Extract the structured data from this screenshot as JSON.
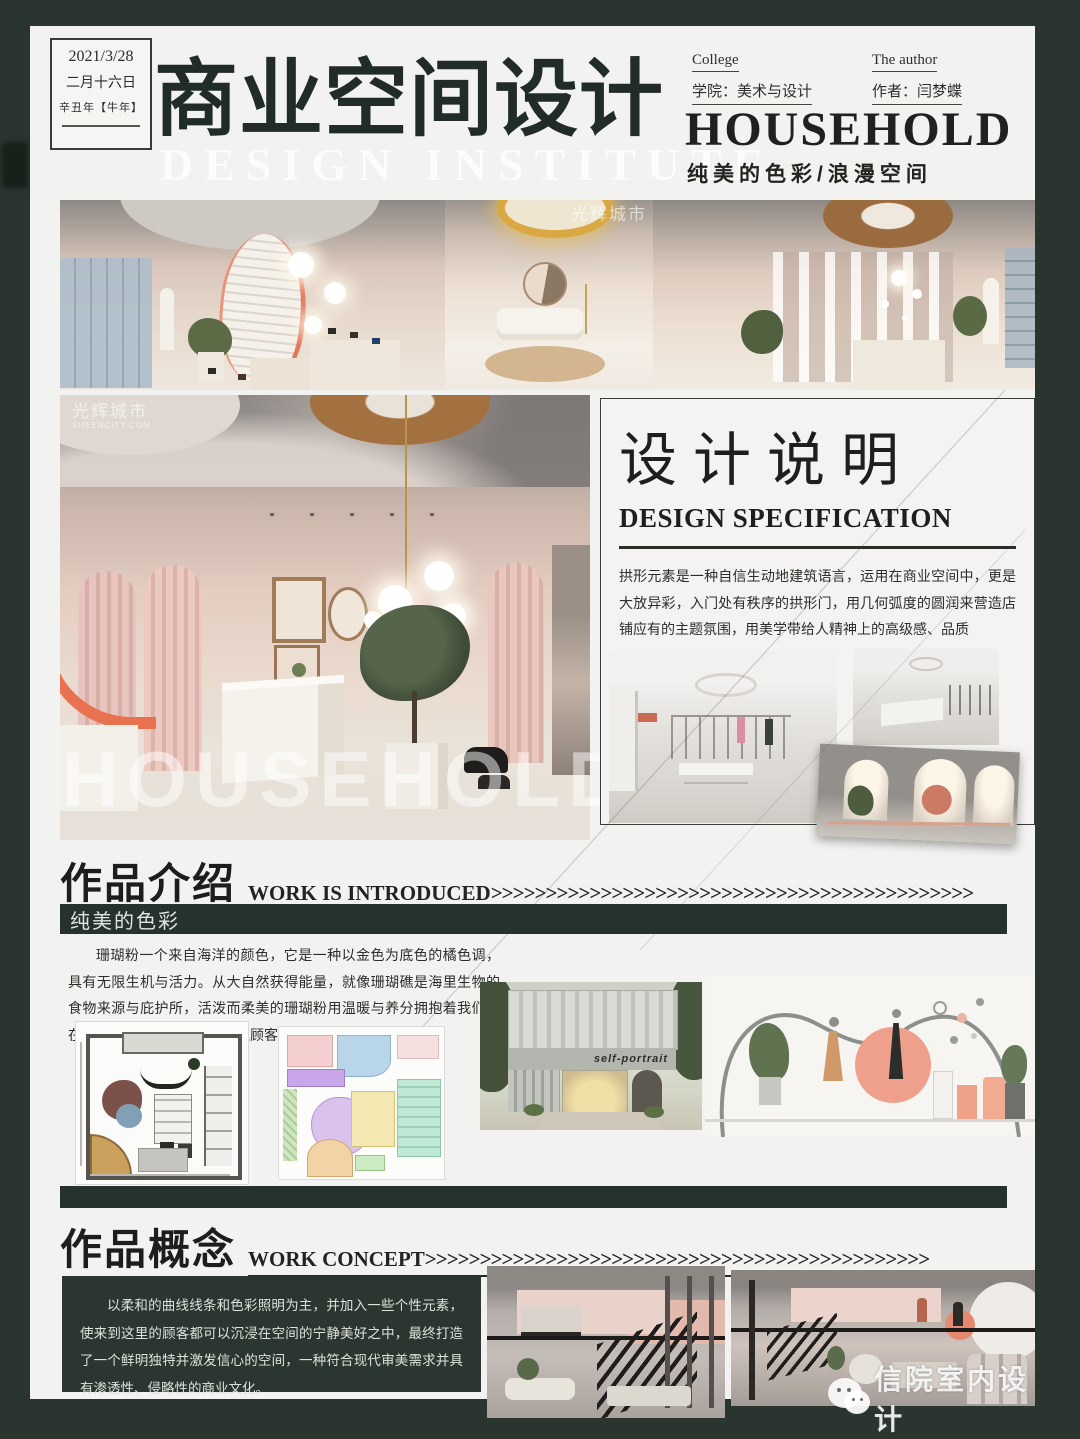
{
  "colors": {
    "accent_green": "#2a362f",
    "coral": "#e8754f",
    "page_bg": "#f2f2f0"
  },
  "header": {
    "date_line1": "2021/3/28",
    "date_line2": "二月十六日",
    "date_line3": "辛丑年【牛年】",
    "title": "商业空间设计",
    "title_watermark": "DESIGN INSTITUTE",
    "college_label": "College",
    "college_value": "学院：美术与设计",
    "author_label": "The author",
    "author_value": "作者：闫梦蝶",
    "brand": "HOUSEHOLD",
    "tagline": "纯美的色彩/浪漫空间"
  },
  "watermarks": {
    "sheencity_cn": "光辉城市",
    "sheencity_en": "SHEENCITY.COM",
    "household": "HOUSEHOLD",
    "wechat_account": "信院室内设计"
  },
  "design_spec": {
    "title_cn": "设计说明",
    "title_en": "DESIGN SPECIFICATION",
    "body": "拱形元素是一种自信生动地建筑语言，运用在商业空间中，更是大放异彩，入门处有秩序的拱形门，用几何弧度的圆润来营造店铺应有的主题氛围，用美学带给人精神上的高级感、品质"
  },
  "work_intro": {
    "title_cn": "作品介绍",
    "title_en": "WORK IS INTRODUCED",
    "arrows": ">>>>>>>>>>>>>>>>>>>>>>>>>>>>>>>>>>>>>>>>>>>>",
    "banner": "纯美的色彩",
    "body": "珊瑚粉一个来自海洋的颜色，它是一种以金色为底色的橘色调，具有无限生机与活力。从大自然获得能量，就像珊瑚礁是海里生物的食物来源与庇护所，活泼而柔美的珊瑚粉用温暖与养分拥抱着我们，在不断色彩渐变的环境中，让顾客觉得舒适愉快。",
    "storefront_sign": "self-portrait"
  },
  "work_concept": {
    "title_cn": "作品概念",
    "title_en": "WORK CONCEPT",
    "arrows": ">>>>>>>>>>>>>>>>>>>>>>>>>>>>>>>>>>>>>>>>>>>>>>",
    "body": "以柔和的曲线线条和色彩照明为主，并加入一些个性元素，使来到这里的顾客都可以沉浸在空间的宁静美好之中，最终打造了一个鲜明独特并激发信心的空间，一种符合现代审美需求并具有渗透性、侵略性的商业文化。"
  }
}
